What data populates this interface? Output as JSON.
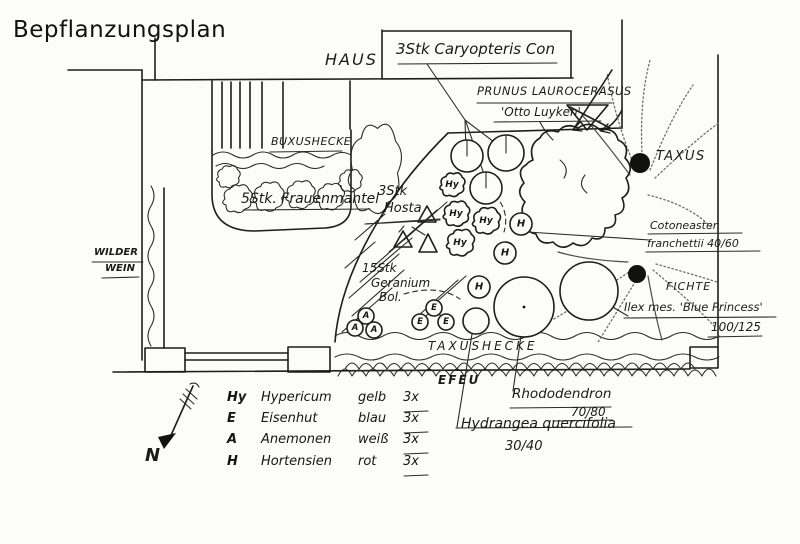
{
  "title": "Bepflanzungsplan",
  "plan": {
    "house_label": "HAUS",
    "labels": {
      "caryopteris": "3Stk Caryopteris Con",
      "prunus_line1": "PRUNUS LAUROCERASUS",
      "prunus_line2": "'Otto Luyken'",
      "taxus": "TAXUS",
      "cotoneaster_line1": "Cotoneaster",
      "cotoneaster_line2": "franchettii 40/60",
      "fichte": "FICHTE",
      "ilex_line1": "Ilex mes. 'Blue Princess'",
      "ilex_line2": "100/125",
      "buxushecke": "BUXUSHECKE",
      "frauenmantel": "5Stk. Frauenmantel",
      "wilder_wein_line1": "WILDER",
      "wilder_wein_line2": "WEIN",
      "hosta_line1": "3Stk",
      "hosta_line2": "Hosta",
      "geranium_line1": "15Stk",
      "geranium_line2": "Geranium",
      "geranium_line3": "Bol.",
      "taxushecke": "TAXUSHECKE",
      "efeu": "EFEU",
      "rhododendron_line1": "Rhododendron",
      "rhododendron_line2": "70/80",
      "hydrangea_line1": "Hydrangea quercifolia",
      "hydrangea_line2": "30/40",
      "north": "N"
    },
    "symbols": {
      "hy": "Hy",
      "e": "E",
      "a": "A",
      "h": "H"
    }
  },
  "legend": {
    "rows": [
      {
        "symbol": "Hy",
        "plant": "Hypericum",
        "color": "gelb",
        "count": "3x"
      },
      {
        "symbol": "E",
        "plant": "Eisenhut",
        "color": "blau",
        "count": "3x"
      },
      {
        "symbol": "A",
        "plant": "Anemonen",
        "color": "weiß",
        "count": "3x"
      },
      {
        "symbol": "H",
        "plant": "Hortensien",
        "color": "rot",
        "count": "3x"
      }
    ]
  },
  "colors": {
    "ink": "#1d1d1d",
    "paper": "#fcfcfa",
    "sketch_gray": "#6e6e6e"
  }
}
